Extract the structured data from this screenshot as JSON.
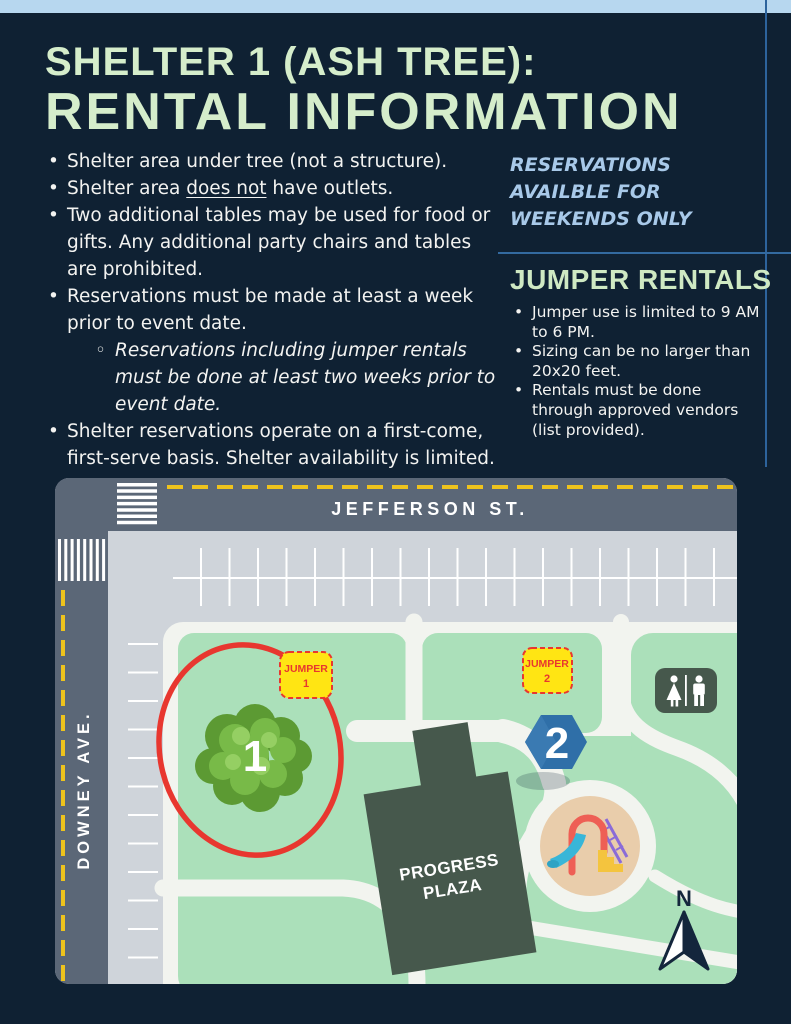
{
  "page": {
    "background": "#0f2133",
    "top_bar_color": "#b7d7ef",
    "accent_rule_color": "#336aa0"
  },
  "header": {
    "title_line1": "SHELTER 1 (ASH TREE):",
    "title_line2": "RENTAL INFORMATION",
    "title_color": "#d5edcb"
  },
  "left_column": {
    "bullets": [
      {
        "text": "Shelter area under tree (not a structure)."
      },
      {
        "pre": "Shelter area ",
        "underlined": "does not",
        "post": " have outlets."
      },
      {
        "text": "Two additional tables may be used for food or gifts. Any additional party chairs and tables are prohibited."
      },
      {
        "text": "Reservations must be made at least a week prior to event date.",
        "sub_note": "Reservations including jumper rentals must be done at least two weeks prior to event date."
      },
      {
        "text": "Shelter reservations operate on a first-come, first-serve basis. Shelter availability is limited."
      }
    ]
  },
  "right_column": {
    "reservations_note": {
      "lines": [
        "RESERVATIONS",
        "AVAILBLE FOR",
        "WEEKENDS ONLY"
      ],
      "color": "#a8c9e9"
    },
    "jumper_rentals": {
      "heading": "JUMPER RENTALS",
      "bullets": [
        "Jumper use is limited to 9 AM to 6 PM.",
        "Sizing can be no larger than 20x20 feet.",
        "Rentals must be done through approved vendors (list provided)."
      ]
    }
  },
  "map": {
    "street_top": "JEFFERSON ST.",
    "street_left": "DOWNEY AVE.",
    "jumper1": {
      "line1": "JUMPER",
      "line2": "1"
    },
    "jumper2": {
      "line1": "JUMPER",
      "line2": "2"
    },
    "tree_marker": "1",
    "hex_marker": "2",
    "building": {
      "line1": "PROGRESS",
      "line2": "PLAZA"
    },
    "compass_label": "N",
    "colors": {
      "road": "#5b6777",
      "parking": "#cfd4da",
      "park_green": "#abe0ba",
      "path_white": "#f2f4ef",
      "lane_yellow": "#eec31d",
      "sign_yellow": "#ffe513",
      "sign_red": "#e8372f",
      "marker_blue": "#2f6fa8",
      "building_green": "#46584c",
      "sand": "#e9cdab",
      "compass_navy": "#14263c"
    }
  }
}
